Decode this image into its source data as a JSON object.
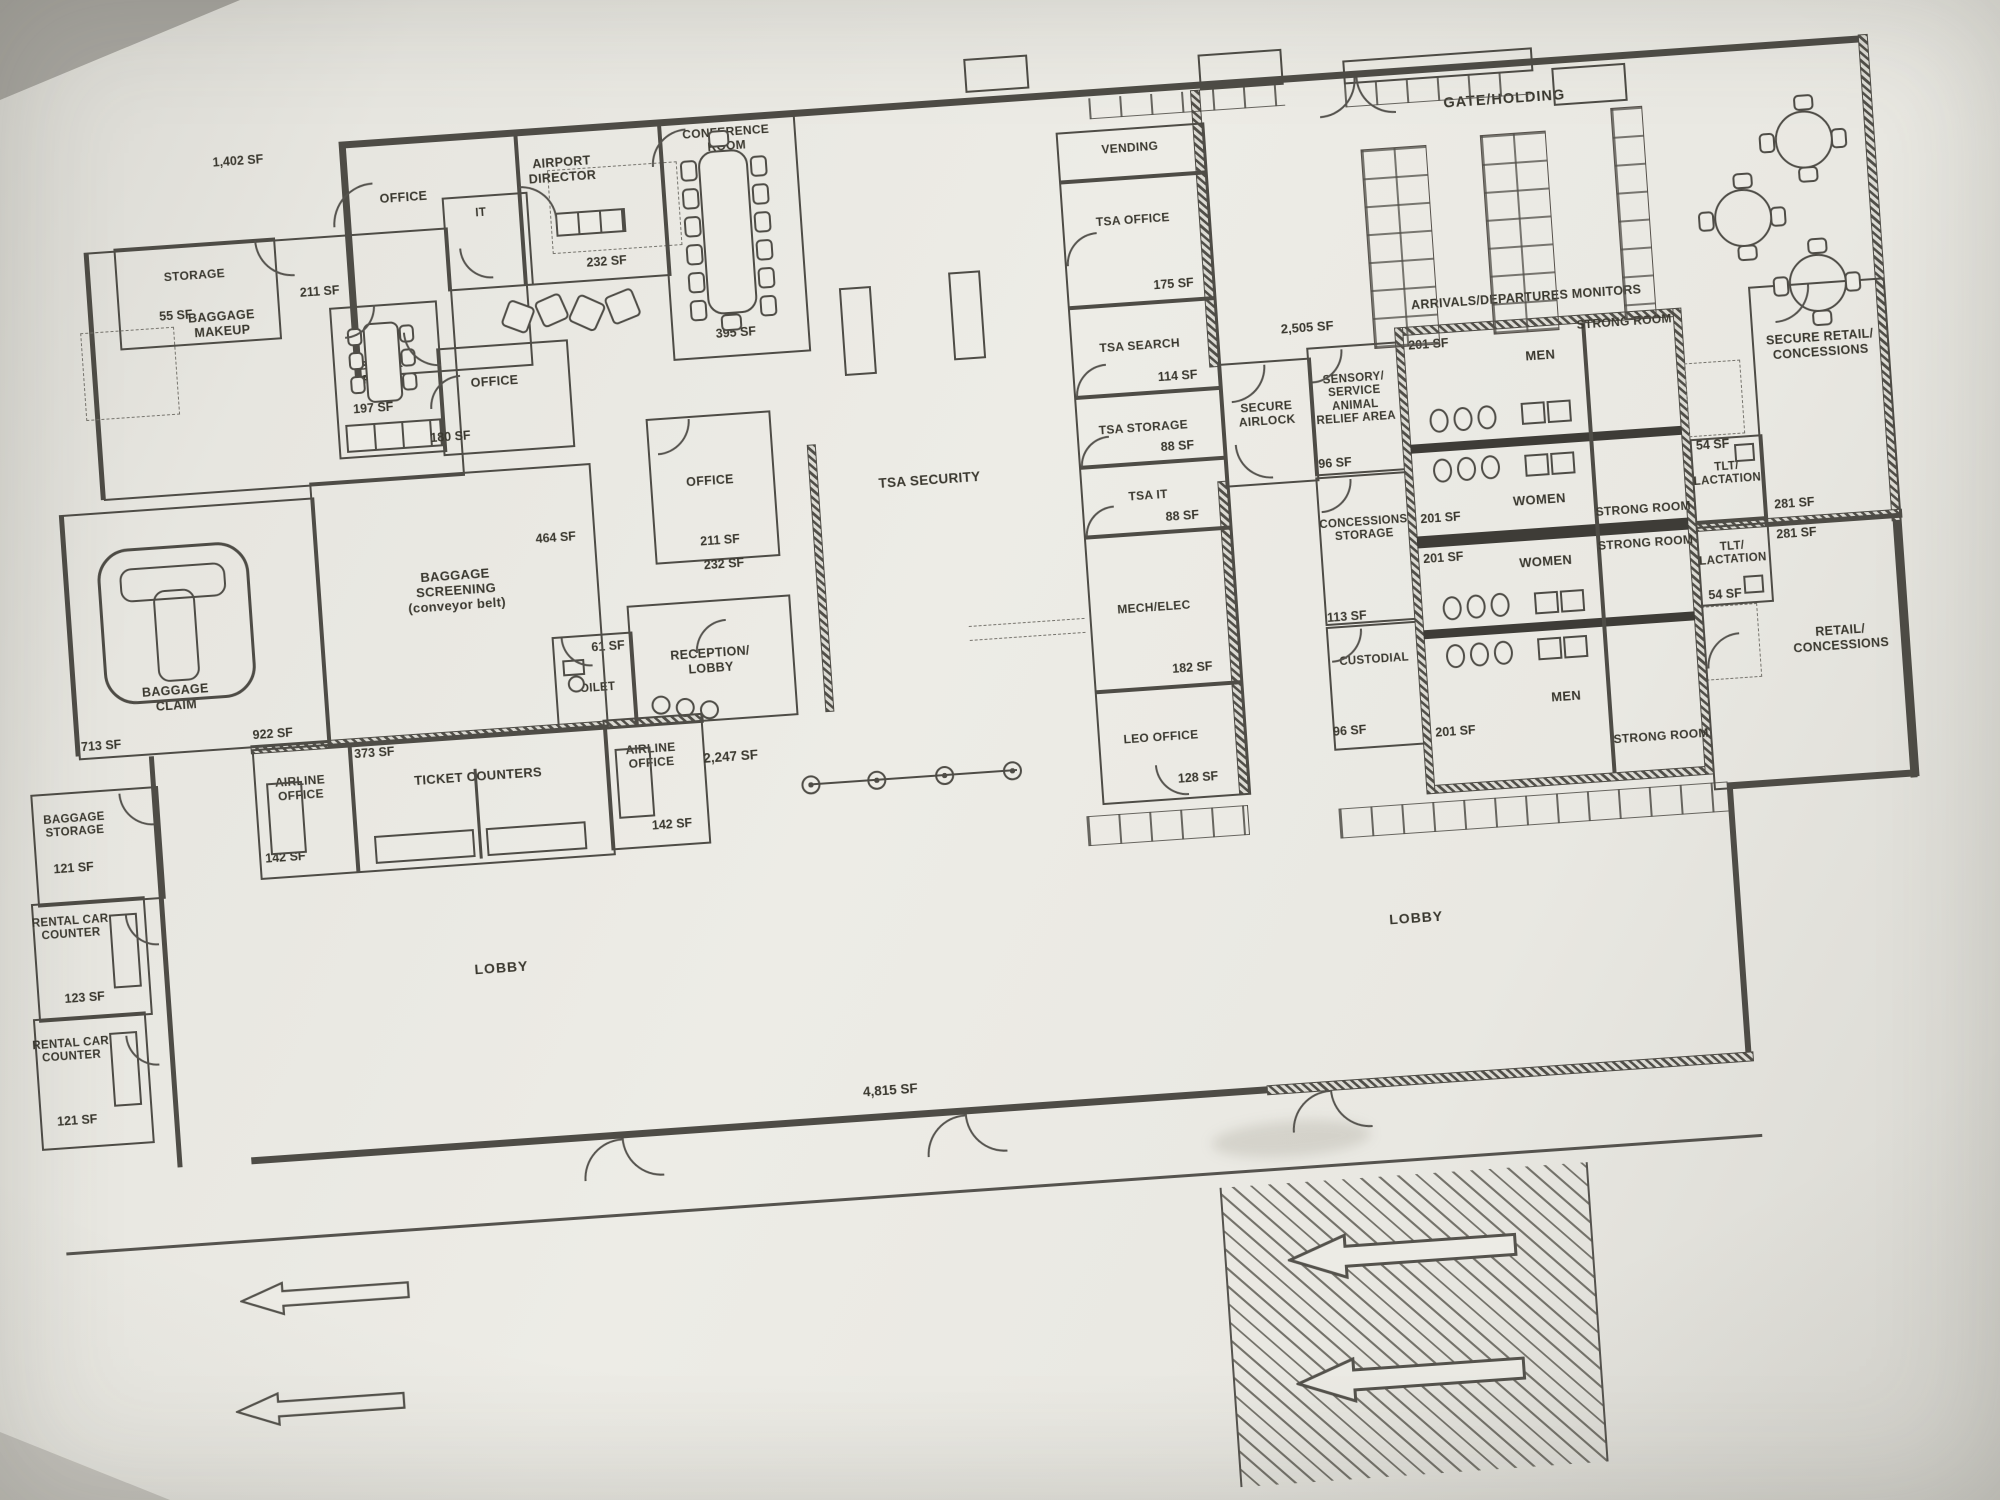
{
  "rooms": {
    "storage": {
      "label": "STORAGE",
      "sf": "55 SF"
    },
    "baggage_makeup": {
      "label": "BAGGAGE\nMAKEUP"
    },
    "office_top": {
      "label": "OFFICE"
    },
    "it": {
      "label": "IT"
    },
    "airport_director": {
      "label": "AIRPORT\nDIRECTOR",
      "sf": "232 SF"
    },
    "conference": {
      "label": "CONFERENCE\nROOM",
      "sf": "395 SF"
    },
    "break_room": {
      "label": "BREAK\nROOM",
      "sf": "197 SF"
    },
    "office_180": {
      "label": "OFFICE",
      "sf": "180 SF"
    },
    "office_mid": {
      "label": "OFFICE",
      "sf": "211 SF",
      "sf2": "232 SF"
    },
    "toilet": {
      "label": "TOILET",
      "sf": "61 SF"
    },
    "reception": {
      "label": "RECEPTION/\nLOBBY"
    },
    "baggage_screening": {
      "label": "BAGGAGE\nSCREENING\n(conveyor belt)",
      "sf": "922 SF"
    },
    "baggage_claim": {
      "label": "BAGGAGE\nCLAIM",
      "sf": "713 SF"
    },
    "airline_office_l": {
      "label": "AIRLINE\nOFFICE",
      "sf": "142 SF"
    },
    "ticket_counters": {
      "label": "TICKET COUNTERS",
      "sf": "373 SF"
    },
    "airline_office_r": {
      "label": "AIRLINE\nOFFICE",
      "sf": "142 SF"
    },
    "baggage_storage": {
      "label": "BAGGAGE\nSTORAGE",
      "sf": "121 SF"
    },
    "rental_1": {
      "label": "RENTAL CAR\nCOUNTER",
      "sf": "123 SF"
    },
    "rental_2": {
      "label": "RENTAL CAR\nCOUNTER",
      "sf": "121 SF"
    },
    "lobby_left": {
      "label": "LOBBY"
    },
    "lobby_right": {
      "label": "LOBBY"
    },
    "tsa_security": {
      "label": "TSA SECURITY"
    },
    "vending": {
      "label": "VENDING"
    },
    "tsa_office": {
      "label": "TSA OFFICE",
      "sf": "175 SF"
    },
    "tsa_search": {
      "label": "TSA SEARCH",
      "sf": "114 SF"
    },
    "tsa_storage": {
      "label": "TSA STORAGE",
      "sf": "88 SF"
    },
    "tsa_it": {
      "label": "TSA IT",
      "sf": "88 SF"
    },
    "mech_elec": {
      "label": "MECH/ELEC",
      "sf": "182 SF"
    },
    "leo_office": {
      "label": "LEO OFFICE",
      "sf": "128 SF"
    },
    "secure_airlock": {
      "label": "SECURE\nAIRLOCK"
    },
    "sensory": {
      "label": "SENSORY/\nSERVICE\nANIMAL\nRELIEF AREA",
      "sf": "96 SF"
    },
    "concessions_storage": {
      "label": "CONCESSIONS\nSTORAGE",
      "sf": "113 SF"
    },
    "custodial": {
      "label": "CUSTODIAL",
      "sf": "96 SF"
    },
    "men_top": {
      "label": "MEN",
      "sf": "201 SF"
    },
    "women_1": {
      "label": "WOMEN",
      "sf": "201 SF"
    },
    "women_2": {
      "label": "WOMEN",
      "sf": "201 SF"
    },
    "men_bottom": {
      "label": "MEN",
      "sf": "201 SF"
    },
    "strong_1": {
      "label": "STRONG ROOM"
    },
    "strong_2": {
      "label": "STRONG ROOM"
    },
    "strong_3": {
      "label": "STRONG ROOM"
    },
    "strong_4": {
      "label": "STRONG ROOM"
    },
    "tlt_1": {
      "label": "TLT/\nLACTATION",
      "sf": "54 SF"
    },
    "tlt_2": {
      "label": "TLT/\nLACTATION",
      "sf": "54 SF"
    },
    "secure_retail": {
      "label": "SECURE RETAIL/\nCONCESSIONS",
      "sf": "281 SF"
    },
    "retail": {
      "label": "RETAIL/\nCONCESSIONS",
      "sf": "281 SF"
    },
    "gate_holding": {
      "label": "GATE/HOLDING"
    }
  },
  "annotations": {
    "monitors": "ARRIVALS/DEPARTURES MONITORS",
    "sf_1402": "1,402 SF",
    "sf_211_wall": "211 SF",
    "sf_464": "464 SF",
    "sf_2505": "2,505 SF",
    "sf_2247": "2,247 SF",
    "sf_4815": "4,815 SF"
  },
  "colors": {
    "ink": "#4e4c46",
    "paper": "#edece6"
  }
}
